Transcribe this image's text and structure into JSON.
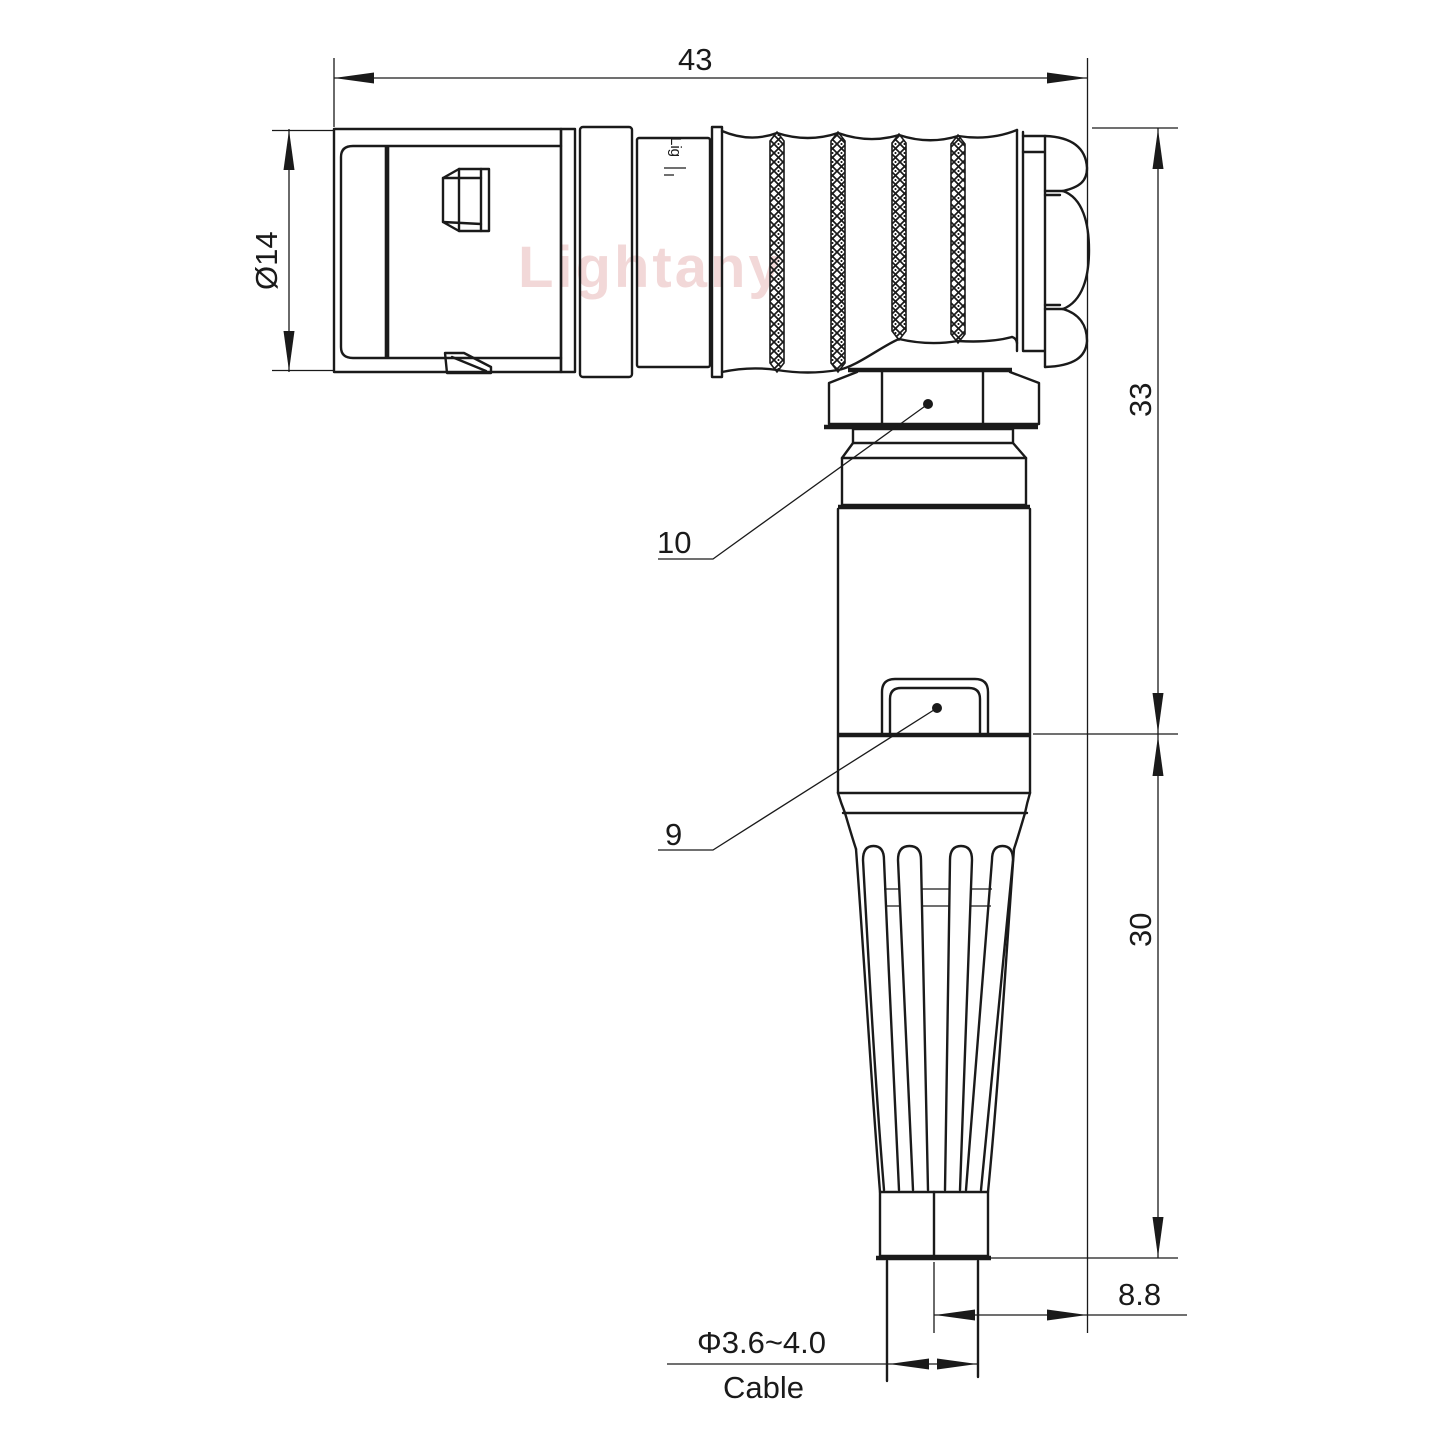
{
  "drawing": {
    "watermark": "Lightany",
    "body_marking": "Lig",
    "dimensions": {
      "overall_length": "43",
      "front_diameter": "Ø14",
      "height_upper": "33",
      "height_lower": "30",
      "cable_offset": "8.8",
      "cable_diameter": "Φ3.6~4.0",
      "cable_label": "Cable",
      "leader_nut": "10",
      "leader_latch": "9"
    },
    "colors": {
      "line": "#1a1a1a",
      "background": "#ffffff",
      "watermark": "#f2d8d8"
    }
  }
}
